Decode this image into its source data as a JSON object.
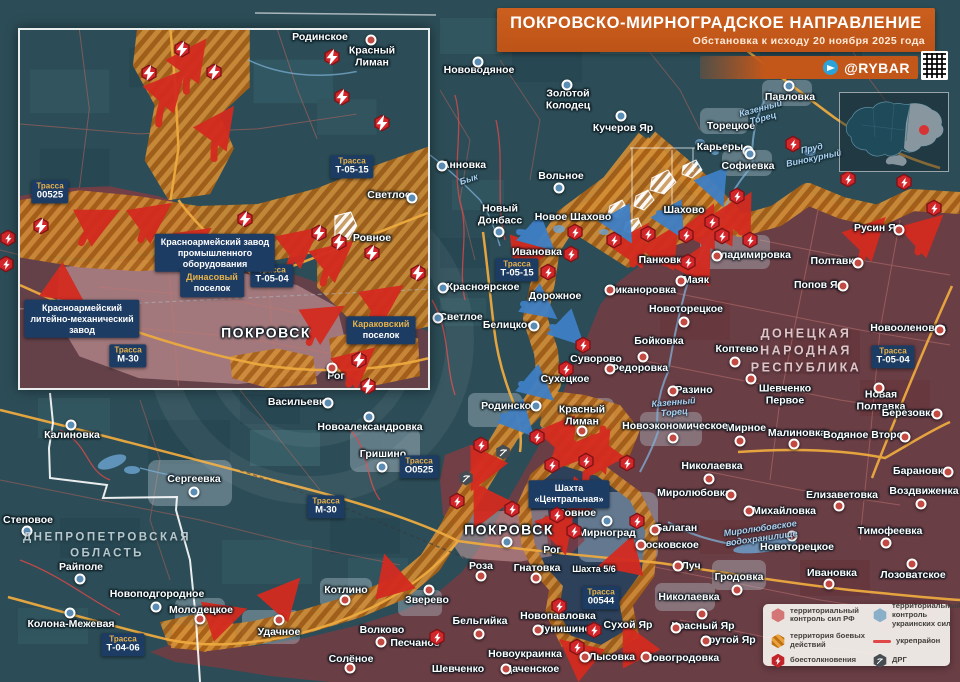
{
  "header": {
    "title": "ПОКРОВСКО-МИРНОГРАДСКОЕ НАПРАВЛЕНИЕ",
    "subtitle": "Обстановка к исходу 20 ноября 2025 года",
    "brand": "@RYBAR"
  },
  "legend": {
    "items": [
      {
        "key": "rf",
        "label": "территориальный контроль сил РФ"
      },
      {
        "key": "ua",
        "label": "территориальный контроль украинских сил"
      },
      {
        "key": "combat",
        "label": "территория боевых действий"
      },
      {
        "key": "fort",
        "label": "укрепрайон"
      },
      {
        "key": "clash",
        "label": "боестолкновения"
      },
      {
        "key": "drg",
        "label": "ДРГ"
      }
    ]
  },
  "colors": {
    "rf_zone": "#7c3a40",
    "ua_zone": "#2c4d57",
    "combat": "#d28d36",
    "accent": "#c3571a",
    "fort": "#e04848",
    "ua_pocket": "#24425f"
  },
  "road_word": "Трасса",
  "regions": [
    {
      "n": "ДОНЕЦКАЯ\nНАРОДНАЯ\nРЕСПУБЛИКА",
      "x": 806,
      "y": 351,
      "c": "dnr"
    },
    {
      "n": "ДНЕПРОПЕТРОВСКАЯ\nОБЛАСТЬ",
      "x": 107,
      "y": 546,
      "c": "dnp"
    }
  ],
  "rivers": [
    {
      "n": "Бык",
      "x": 469,
      "y": 180,
      "r": -18
    },
    {
      "n": "Казенный\nТорец",
      "x": 762,
      "y": 114,
      "r": -15
    },
    {
      "n": "Казенный\nТорец",
      "x": 674,
      "y": 408,
      "r": -5
    },
    {
      "n": "Миролюбовское\nводохранилище",
      "x": 761,
      "y": 534,
      "r": -8
    },
    {
      "n": "Пруд\nВинокурный",
      "x": 813,
      "y": 154,
      "r": -12
    }
  ],
  "roads": [
    {
      "n": "Т-05-15",
      "x": 517,
      "y": 270
    },
    {
      "n": "О0525",
      "x": 419,
      "y": 467
    },
    {
      "n": "М-30",
      "x": 326,
      "y": 507
    },
    {
      "n": "Т-05-04",
      "x": 893,
      "y": 357
    },
    {
      "n": "00544",
      "x": 601,
      "y": 598
    },
    {
      "n": "Т-04-06",
      "x": 123,
      "y": 645
    }
  ],
  "callouts": [
    {
      "t": "Шахта\n«Центральная»",
      "x": 569,
      "y": 494
    }
  ],
  "places": [
    {
      "n": "Нововодяное",
      "x": 479,
      "y": 71,
      "d": [
        478,
        62
      ],
      "dc": "b"
    },
    {
      "n": "Золотой\nКолодец",
      "x": 568,
      "y": 100,
      "d": [
        567,
        85
      ],
      "dc": "b"
    },
    {
      "n": "Кучеров Яр",
      "x": 623,
      "y": 129,
      "d": [
        621,
        116
      ],
      "dc": "b"
    },
    {
      "n": "Павловка",
      "x": 790,
      "y": 98,
      "d": [
        789,
        86
      ],
      "dc": "b"
    },
    {
      "n": "Торецкое",
      "x": 731,
      "y": 127
    },
    {
      "n": "Карьеры",
      "x": 720,
      "y": 148,
      "d": [
        748,
        151
      ],
      "dc": "b"
    },
    {
      "n": "Софиевка",
      "x": 748,
      "y": 167,
      "d": [
        750,
        154
      ],
      "dc": "b"
    },
    {
      "n": "Анновка",
      "x": 464,
      "y": 166,
      "d": [
        442,
        166
      ],
      "dc": "b"
    },
    {
      "n": "Вольное",
      "x": 561,
      "y": 177,
      "d": [
        559,
        188
      ],
      "dc": "b"
    },
    {
      "n": "Новый\nДонбасс",
      "x": 500,
      "y": 215,
      "d": [
        499,
        232
      ],
      "dc": "b"
    },
    {
      "n": "Новое Шахово",
      "x": 573,
      "y": 218
    },
    {
      "n": "Шахово",
      "x": 684,
      "y": 211
    },
    {
      "n": "Ивановка",
      "x": 537,
      "y": 253
    },
    {
      "n": "Панковка",
      "x": 663,
      "y": 261
    },
    {
      "n": "Маяк",
      "x": 696,
      "y": 281,
      "d": [
        681,
        281
      ],
      "dc": "r"
    },
    {
      "n": "Никаноровка",
      "x": 642,
      "y": 291,
      "d": [
        610,
        290
      ],
      "dc": "r"
    },
    {
      "n": "Новоторецкое",
      "x": 686,
      "y": 310,
      "d": [
        684,
        322
      ],
      "dc": "r"
    },
    {
      "n": "Попов Яр",
      "x": 819,
      "y": 286,
      "d": [
        843,
        286
      ],
      "dc": "r"
    },
    {
      "n": "Полтавка",
      "x": 835,
      "y": 262,
      "d": [
        858,
        263
      ],
      "dc": "r"
    },
    {
      "n": "Русин Яр",
      "x": 878,
      "y": 229,
      "d": [
        899,
        230
      ],
      "dc": "r"
    },
    {
      "n": "Владимировка",
      "x": 752,
      "y": 256,
      "d": [
        717,
        256
      ],
      "dc": "r"
    },
    {
      "n": "Новооленовка",
      "x": 908,
      "y": 329,
      "d": [
        940,
        330
      ],
      "dc": "r"
    },
    {
      "n": "Бойковка",
      "x": 659,
      "y": 342,
      "d": [
        643,
        357
      ],
      "dc": "r"
    },
    {
      "n": "Коптево",
      "x": 737,
      "y": 350,
      "d": [
        735,
        362
      ],
      "dc": "r"
    },
    {
      "n": "Федоровка",
      "x": 639,
      "y": 369,
      "d": [
        610,
        369
      ],
      "dc": "r"
    },
    {
      "n": "Разино",
      "x": 694,
      "y": 391,
      "d": [
        673,
        391
      ],
      "dc": "r"
    },
    {
      "n": "Суворово",
      "x": 596,
      "y": 360
    },
    {
      "n": "Сухецкое",
      "x": 565,
      "y": 380
    },
    {
      "n": "Шевченко\nПервое",
      "x": 785,
      "y": 395,
      "d": [
        751,
        379
      ],
      "dc": "r"
    },
    {
      "n": "Новая Полтавка",
      "x": 881,
      "y": 401,
      "d": [
        879,
        388
      ],
      "dc": "r"
    },
    {
      "n": "Березовка",
      "x": 909,
      "y": 414,
      "d": [
        937,
        414
      ],
      "dc": "r"
    },
    {
      "n": "Мирное",
      "x": 746,
      "y": 429,
      "d": [
        740,
        441
      ],
      "dc": "r"
    },
    {
      "n": "Малиновка",
      "x": 797,
      "y": 434,
      "d": [
        794,
        444
      ],
      "dc": "r"
    },
    {
      "n": "Водяное Второе",
      "x": 866,
      "y": 436,
      "d": [
        905,
        437
      ],
      "dc": "r"
    },
    {
      "n": "Новоэкономическое",
      "x": 675,
      "y": 427,
      "d": [
        673,
        438
      ],
      "dc": "r"
    },
    {
      "n": "Красный\nЛиман",
      "x": 582,
      "y": 416,
      "d": [
        582,
        431
      ],
      "dc": "r"
    },
    {
      "n": "Родинское",
      "x": 509,
      "y": 407,
      "d": [
        536,
        406
      ],
      "dc": "b"
    },
    {
      "n": "Светлое",
      "x": 461,
      "y": 318,
      "d": [
        438,
        318
      ],
      "dc": "b"
    },
    {
      "n": "Красноярское",
      "x": 483,
      "y": 288,
      "d": [
        443,
        288
      ],
      "dc": "b"
    },
    {
      "n": "Белицкое",
      "x": 508,
      "y": 326,
      "d": [
        534,
        326
      ],
      "dc": "b"
    },
    {
      "n": "Дорожное",
      "x": 555,
      "y": 297
    },
    {
      "n": "Васильевка",
      "x": 299,
      "y": 403,
      "d": [
        328,
        403
      ],
      "dc": "b"
    },
    {
      "n": "Новоалександровка",
      "x": 370,
      "y": 428,
      "d": [
        369,
        417
      ],
      "dc": "b"
    },
    {
      "n": "Гришино",
      "x": 383,
      "y": 455,
      "d": [
        382,
        467
      ],
      "dc": "b"
    },
    {
      "n": "Калиновка",
      "x": 72,
      "y": 436,
      "d": [
        71,
        425
      ],
      "dc": "b"
    },
    {
      "n": "Сергеевка",
      "x": 194,
      "y": 480,
      "d": [
        194,
        492
      ],
      "dc": "b"
    },
    {
      "n": "Степовое",
      "x": 28,
      "y": 521,
      "d": [
        27,
        531
      ],
      "dc": "b"
    },
    {
      "n": "Райполе",
      "x": 81,
      "y": 568,
      "d": [
        80,
        579
      ],
      "dc": "b"
    },
    {
      "n": "Новоподгородное",
      "x": 157,
      "y": 595,
      "d": [
        156,
        607
      ],
      "dc": "b"
    },
    {
      "n": "Молодецкое",
      "x": 201,
      "y": 611,
      "d": [
        200,
        619
      ],
      "dc": "r"
    },
    {
      "n": "Колона-Межевая",
      "x": 71,
      "y": 625,
      "d": [
        70,
        613
      ],
      "dc": "b"
    },
    {
      "n": "Удачное",
      "x": 279,
      "y": 633,
      "d": [
        279,
        620
      ],
      "dc": "r"
    },
    {
      "n": "Котлино",
      "x": 346,
      "y": 591,
      "d": [
        345,
        600
      ],
      "dc": "r"
    },
    {
      "n": "Зверево",
      "x": 427,
      "y": 601,
      "d": [
        429,
        590
      ],
      "dc": "r"
    },
    {
      "n": "Волково",
      "x": 382,
      "y": 631,
      "d": [
        381,
        642
      ],
      "dc": "r"
    },
    {
      "n": "Песчаное",
      "x": 415,
      "y": 644
    },
    {
      "n": "Солёное",
      "x": 351,
      "y": 660,
      "d": [
        350,
        668
      ],
      "dc": "r"
    },
    {
      "n": "ПОКРОВСК",
      "x": 509,
      "y": 530,
      "c": "major",
      "d": [
        507,
        542
      ],
      "dc": "b"
    },
    {
      "n": "Мирноград",
      "x": 607,
      "y": 534,
      "d": [
        607,
        521
      ],
      "dc": "b"
    },
    {
      "n": "Ровное",
      "x": 577,
      "y": 514
    },
    {
      "n": "Рог",
      "x": 552,
      "y": 551
    },
    {
      "n": "Шахта 5/6",
      "x": 594,
      "y": 570,
      "c": "small"
    },
    {
      "n": "Роза",
      "x": 481,
      "y": 567,
      "d": [
        481,
        576
      ],
      "dc": "r"
    },
    {
      "n": "Гнатовка",
      "x": 537,
      "y": 569,
      "d": [
        536,
        578
      ],
      "dc": "r"
    },
    {
      "n": "Бельгийка",
      "x": 480,
      "y": 622,
      "d": [
        479,
        634
      ],
      "dc": "r"
    },
    {
      "n": "Новопавловка",
      "x": 558,
      "y": 617
    },
    {
      "n": "Чунишино",
      "x": 564,
      "y": 630,
      "d": [
        538,
        630
      ],
      "dc": "r"
    },
    {
      "n": "Новоукраинка",
      "x": 525,
      "y": 655
    },
    {
      "n": "Шевченко",
      "x": 458,
      "y": 670
    },
    {
      "n": "Даченское",
      "x": 532,
      "y": 670,
      "d": [
        506,
        669
      ],
      "dc": "r"
    },
    {
      "n": "Лысовка",
      "x": 612,
      "y": 658,
      "d": [
        585,
        657
      ],
      "dc": "r"
    },
    {
      "n": "Сухой Яр",
      "x": 628,
      "y": 626
    },
    {
      "n": "Новогродовка",
      "x": 682,
      "y": 659,
      "d": [
        646,
        657
      ],
      "dc": "r"
    },
    {
      "n": "Лозоватское",
      "x": 913,
      "y": 576,
      "d": [
        912,
        564
      ],
      "dc": "r"
    },
    {
      "n": "Ивановка",
      "x": 832,
      "y": 574,
      "d": [
        829,
        584
      ],
      "dc": "r"
    },
    {
      "n": "Луч",
      "x": 691,
      "y": 567,
      "d": [
        678,
        566
      ],
      "dc": "r"
    },
    {
      "n": "Гродовка",
      "x": 739,
      "y": 578,
      "d": [
        737,
        590
      ],
      "dc": "r"
    },
    {
      "n": "Николаевка",
      "x": 689,
      "y": 598,
      "d": [
        702,
        614
      ],
      "dc": "r"
    },
    {
      "n": "Красный Яр",
      "x": 703,
      "y": 627,
      "d": [
        676,
        628
      ],
      "dc": "r"
    },
    {
      "n": "Крутой Яр",
      "x": 729,
      "y": 641,
      "d": [
        706,
        641
      ],
      "dc": "r"
    },
    {
      "n": "Московское",
      "x": 668,
      "y": 546,
      "d": [
        641,
        545
      ],
      "dc": "r"
    },
    {
      "n": "Балаган",
      "x": 676,
      "y": 529,
      "d": [
        655,
        530
      ],
      "dc": "r"
    },
    {
      "n": "Николаевка",
      "x": 712,
      "y": 467,
      "d": [
        709,
        479
      ],
      "dc": "r"
    },
    {
      "n": "Миролюбовка",
      "x": 694,
      "y": 494,
      "d": [
        731,
        495
      ],
      "dc": "r"
    },
    {
      "n": "Михайловка",
      "x": 784,
      "y": 512,
      "d": [
        749,
        511
      ],
      "dc": "r"
    },
    {
      "n": "Барановка",
      "x": 921,
      "y": 472,
      "d": [
        948,
        472
      ],
      "dc": "r"
    },
    {
      "n": "Воздвиженка",
      "x": 924,
      "y": 492,
      "d": [
        921,
        504
      ],
      "dc": "r"
    },
    {
      "n": "Елизаветовка",
      "x": 842,
      "y": 496,
      "d": [
        839,
        506
      ],
      "dc": "r"
    },
    {
      "n": "Тимофеевка",
      "x": 890,
      "y": 532,
      "d": [
        886,
        543
      ],
      "dc": "r"
    },
    {
      "n": "Новоторецкое",
      "x": 797,
      "y": 548,
      "d": [
        792,
        536
      ],
      "dc": "r"
    }
  ],
  "icons": {
    "clash": [
      [
        548,
        272
      ],
      [
        571,
        254
      ],
      [
        575,
        232
      ],
      [
        614,
        240
      ],
      [
        648,
        234
      ],
      [
        686,
        235
      ],
      [
        712,
        222
      ],
      [
        722,
        236
      ],
      [
        737,
        196
      ],
      [
        750,
        240
      ],
      [
        688,
        262
      ],
      [
        793,
        144
      ],
      [
        848,
        179
      ],
      [
        904,
        182
      ],
      [
        934,
        208
      ],
      [
        566,
        369
      ],
      [
        583,
        345
      ],
      [
        481,
        445
      ],
      [
        537,
        437
      ],
      [
        552,
        465
      ],
      [
        586,
        461
      ],
      [
        627,
        463
      ],
      [
        457,
        501
      ],
      [
        512,
        509
      ],
      [
        557,
        515
      ],
      [
        574,
        531
      ],
      [
        637,
        521
      ],
      [
        559,
        606
      ],
      [
        594,
        630
      ],
      [
        577,
        647
      ],
      [
        437,
        637
      ],
      [
        8,
        238
      ],
      [
        6,
        264
      ]
    ],
    "drg": [
      [
        466,
        478
      ],
      [
        503,
        452
      ]
    ]
  },
  "arrows": {
    "red": [
      [
        705,
        246,
        708,
        216
      ],
      [
        723,
        240,
        728,
        212
      ],
      [
        741,
        232,
        745,
        204
      ],
      [
        633,
        264,
        641,
        234
      ],
      [
        665,
        263,
        671,
        236
      ],
      [
        700,
        281,
        704,
        252
      ],
      [
        862,
        258,
        876,
        227
      ],
      [
        918,
        252,
        933,
        224
      ],
      [
        506,
        269,
        540,
        252
      ],
      [
        572,
        428,
        557,
        462
      ],
      [
        603,
        429,
        592,
        468
      ],
      [
        586,
        473,
        573,
        511
      ],
      [
        546,
        520,
        562,
        542
      ],
      [
        631,
        549,
        611,
        563
      ],
      [
        647,
        651,
        629,
        634
      ],
      [
        590,
        655,
        570,
        648
      ],
      [
        285,
        603,
        291,
        588
      ],
      [
        216,
        627,
        234,
        613
      ],
      [
        398,
        581,
        388,
        567
      ],
      [
        480,
        452,
        477,
        479
      ],
      [
        483,
        490,
        480,
        517
      ],
      [
        549,
        430,
        566,
        449
      ],
      [
        588,
        447,
        601,
        462
      ]
    ],
    "blue": [
      [
        607,
        217,
        626,
        233
      ],
      [
        659,
        213,
        678,
        229
      ],
      [
        704,
        179,
        719,
        196
      ],
      [
        519,
        232,
        546,
        243
      ],
      [
        523,
        304,
        548,
        312
      ],
      [
        552,
        327,
        576,
        338
      ],
      [
        521,
        384,
        545,
        393
      ],
      [
        503,
        416,
        526,
        428
      ]
    ]
  },
  "inset": {
    "places": [
      {
        "n": "Родинское",
        "x": 300,
        "y": 8
      },
      {
        "n": "Красный\nЛиман",
        "x": 352,
        "y": 27,
        "d": [
          351,
          10
        ],
        "dc": "r"
      },
      {
        "n": "Светлое",
        "x": 369,
        "y": 166,
        "d": [
          392,
          168
        ],
        "dc": "b"
      },
      {
        "n": "Ровное",
        "x": 352,
        "y": 209
      },
      {
        "n": "ПОКРОВСК",
        "x": 246,
        "y": 303,
        "c": "major"
      },
      {
        "n": "Рог",
        "x": 316,
        "y": 347,
        "d": [
          312,
          338
        ],
        "dc": "r"
      }
    ],
    "callouts": [
      {
        "t": "Красноармейский завод\nпромышленного\nоборудования",
        "x": 195,
        "y": 223
      },
      {
        "t": "Динасовый\nпоселок",
        "x": 192,
        "y": 253,
        "a": 1
      },
      {
        "t": "Красноармейский\nлитейно-механический\nзавод",
        "x": 62,
        "y": 289
      },
      {
        "t": "Караковский\nпоселок",
        "x": 361,
        "y": 300,
        "a": 1
      }
    ],
    "roads": [
      {
        "n": "Т-05-15",
        "x": 332,
        "y": 137
      },
      {
        "n": "00525",
        "x": 30,
        "y": 162
      },
      {
        "n": "Т-05-04",
        "x": 252,
        "y": 246
      },
      {
        "n": "М-30",
        "x": 108,
        "y": 326
      }
    ],
    "clash": [
      [
        162,
        19
      ],
      [
        194,
        42
      ],
      [
        129,
        43
      ],
      [
        312,
        27
      ],
      [
        322,
        67
      ],
      [
        362,
        93
      ],
      [
        21,
        196
      ],
      [
        225,
        189
      ],
      [
        299,
        203
      ],
      [
        319,
        212
      ],
      [
        352,
        223
      ],
      [
        398,
        243
      ],
      [
        339,
        330
      ],
      [
        348,
        356
      ]
    ],
    "arrows": [
      [
        140,
        95,
        158,
        50
      ],
      [
        168,
        62,
        180,
        20
      ],
      [
        196,
        130,
        208,
        88
      ],
      [
        62,
        215,
        88,
        188
      ],
      [
        122,
        212,
        142,
        183
      ],
      [
        162,
        236,
        182,
        208
      ],
      [
        272,
        240,
        292,
        208
      ],
      [
        306,
        256,
        326,
        222
      ],
      [
        352,
        300,
        376,
        266
      ],
      [
        292,
        316,
        316,
        286
      ],
      [
        332,
        358,
        348,
        330
      ],
      [
        32,
        262,
        54,
        268
      ]
    ]
  }
}
